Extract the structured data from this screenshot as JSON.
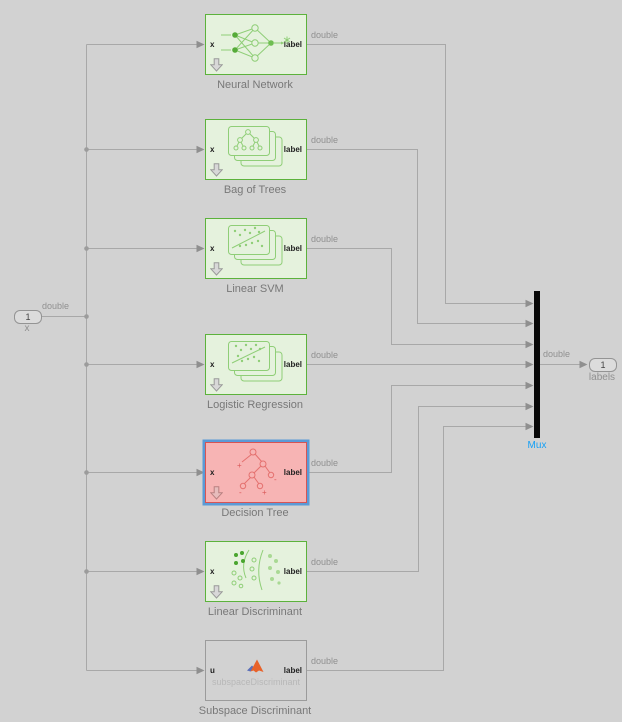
{
  "signal_label": "double",
  "input_port": {
    "number": "1",
    "name": "x"
  },
  "output_port": {
    "number": "1",
    "name": "labels"
  },
  "mux": {
    "label": "Mux"
  },
  "blocks": [
    {
      "name": "Neural Network",
      "input": "x",
      "output": "label"
    },
    {
      "name": "Bag of Trees",
      "input": "x",
      "output": "label"
    },
    {
      "name": "Linear SVM",
      "input": "x",
      "output": "label"
    },
    {
      "name": "Logistic Regression",
      "input": "x",
      "output": "label"
    },
    {
      "name": "Decision Tree",
      "input": "x",
      "output": "label",
      "state": "selected"
    },
    {
      "name": "Linear Discriminant",
      "input": "x",
      "output": "label"
    },
    {
      "name": "Subspace Discriminant",
      "input": "u",
      "output": "label",
      "code_label": "subspaceDiscriminant"
    }
  ],
  "colors": {
    "bg": "#d2d2d2",
    "wire": "#a8a8a8",
    "green_border": "#5cb23c",
    "green_fill": "#e5f2dd",
    "red_border": "#d75454",
    "red_fill": "#f7b4b4",
    "selection": "#5b9ad6",
    "mux_label": "#16a0f5",
    "matlab_orange": "#e8622a",
    "matlab_blue": "#5b6fb8"
  }
}
